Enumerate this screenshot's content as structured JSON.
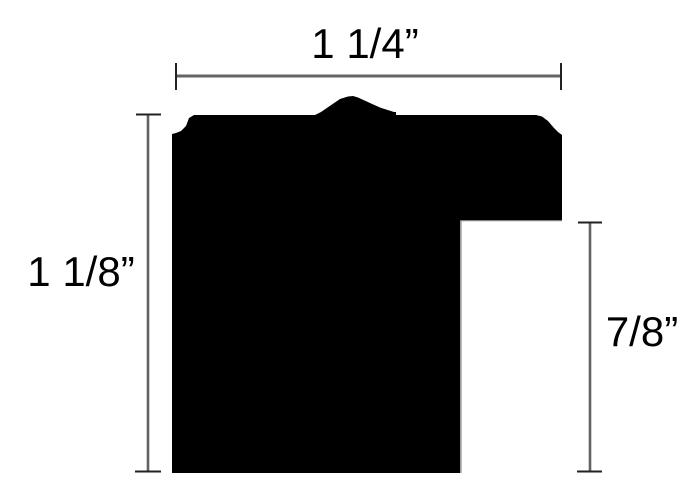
{
  "theme": {
    "background": "#ffffff",
    "shape_fill": "#000000",
    "dimension_line_color": "#636363",
    "tick_color": "#222222",
    "edge_hairline_color": "#808080",
    "label_color": "#000000"
  },
  "diagram": {
    "shape": {
      "profile_points": "172,473 172,134 176,133 181,131 186,126 189,118 194,115 315,115 321,112 340,99 348,96.5 353,96 358,97.5 370,103 380,107.5 394,112 396,112 396,115 536,115 542,116.5 548,121 554,128 558,132 562,135 562,221 460,221 460,473",
      "notch_hairline_path": "M 562,220.6 L 460.9,220.6 L 460.9,473"
    },
    "dimensions": {
      "top": {
        "label": "1 1/4”"
      },
      "left": {
        "label": "1 1/8”"
      },
      "right": {
        "label": "7/8”"
      }
    }
  }
}
